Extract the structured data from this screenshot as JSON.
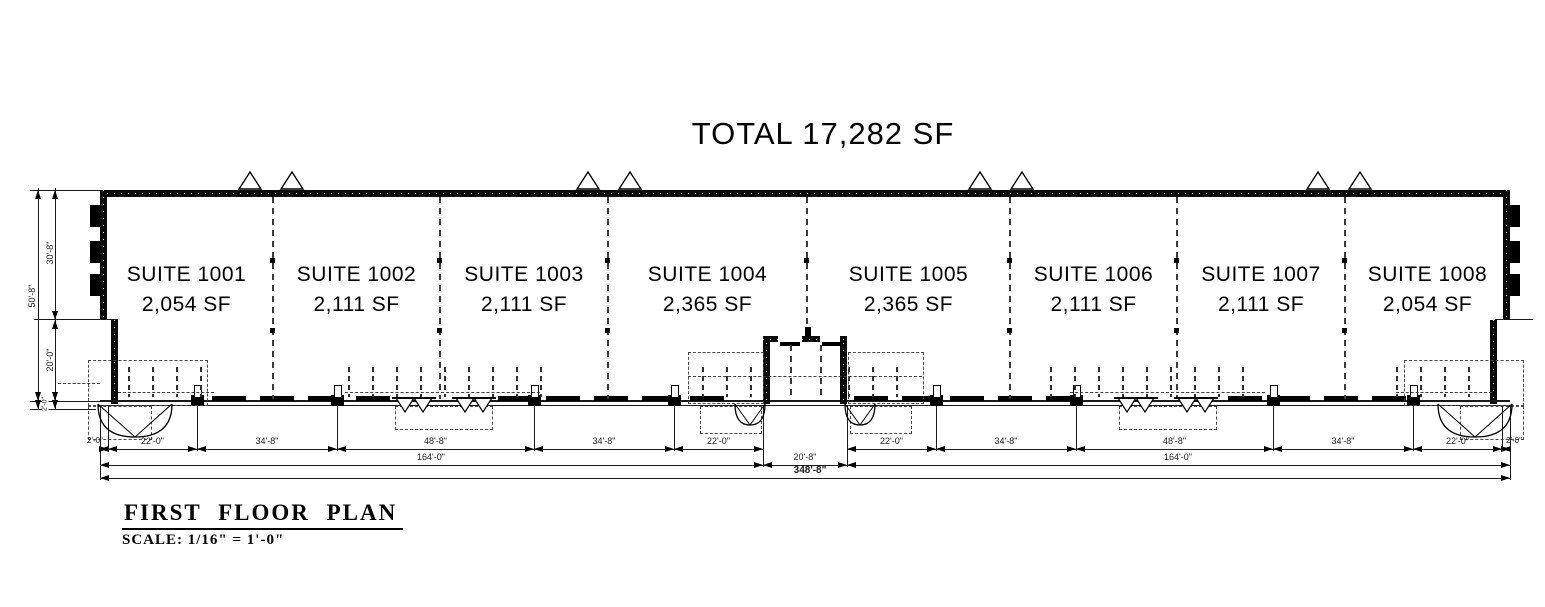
{
  "drawing": {
    "total_label": "TOTAL 17,282 SF",
    "plan_title": "FIRST FLOOR PLAN",
    "plan_scale": "SCALE: 1/16\" = 1'-0\""
  },
  "suites": [
    {
      "name": "SUITE 1001",
      "area": "2,054 SF"
    },
    {
      "name": "SUITE 1002",
      "area": "2,111 SF"
    },
    {
      "name": "SUITE 1003",
      "area": "2,111 SF"
    },
    {
      "name": "SUITE 1004",
      "area": "2,365 SF"
    },
    {
      "name": "SUITE 1005",
      "area": "2,365 SF"
    },
    {
      "name": "SUITE 1006",
      "area": "2,111 SF"
    },
    {
      "name": "SUITE 1007",
      "area": "2,111 SF"
    },
    {
      "name": "SUITE 1008",
      "area": "2,054 SF"
    }
  ],
  "dimensions": {
    "bottom_row1": [
      "2'-0\"",
      "22'-0\"",
      "34'-8\"",
      "48'-8\"",
      "34'-8\"",
      "22'-0\"",
      "22'-0\"",
      "34'-8\"",
      "48'-8\"",
      "34'-8\"",
      "22'-0\"",
      "2'-0\""
    ],
    "bottom_row2": [
      "164'-0\"",
      "20'-8\"",
      "164'-0\""
    ],
    "bottom_total": "348'-8\"",
    "left_top": "30'-8\"",
    "left_bottom": "20'-0\"",
    "left_overall": "50'-8\"",
    "left_small": "2'-0\""
  },
  "colors": {
    "ink": "#000000",
    "background": "#ffffff"
  }
}
